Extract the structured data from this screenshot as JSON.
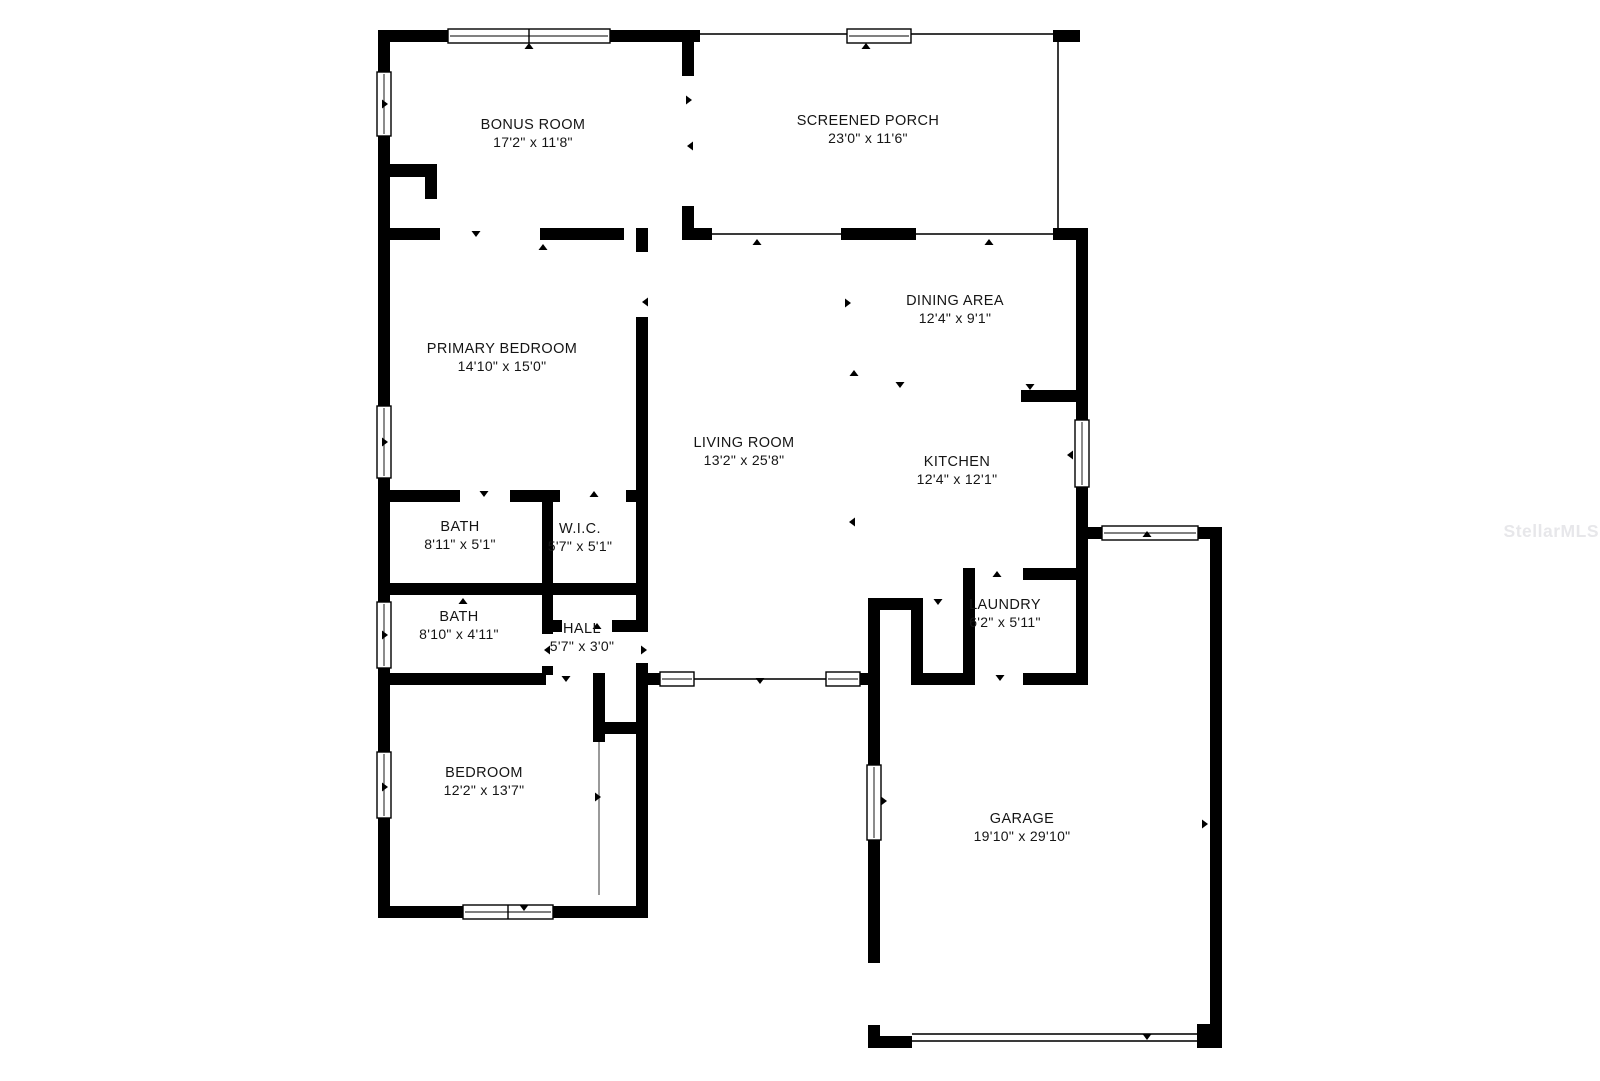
{
  "watermark": "StellarMLS",
  "plan": {
    "rooms": [
      {
        "id": "bonus-room",
        "name": "BONUS ROOM",
        "dims": "17'2\" x 11'8\""
      },
      {
        "id": "screened-porch",
        "name": "SCREENED PORCH",
        "dims": "23'0\" x 11'6\""
      },
      {
        "id": "primary-bedroom",
        "name": "PRIMARY BEDROOM",
        "dims": "14'10\" x 15'0\""
      },
      {
        "id": "dining-area",
        "name": "DINING AREA",
        "dims": "12'4\" x 9'1\""
      },
      {
        "id": "living-room",
        "name": "LIVING ROOM",
        "dims": "13'2\" x 25'8\""
      },
      {
        "id": "kitchen",
        "name": "KITCHEN",
        "dims": "12'4\" x 12'1\""
      },
      {
        "id": "bath-1",
        "name": "BATH",
        "dims": "8'11\" x 5'1\""
      },
      {
        "id": "wic",
        "name": "W.I.C.",
        "dims": "5'7\" x 5'1\""
      },
      {
        "id": "bath-2",
        "name": "BATH",
        "dims": "8'10\" x 4'11\""
      },
      {
        "id": "hall",
        "name": "HALL",
        "dims": "5'7\" x 3'0\""
      },
      {
        "id": "laundry",
        "name": "LAUNDRY",
        "dims": "6'2\" x 5'11\""
      },
      {
        "id": "bedroom",
        "name": "BEDROOM",
        "dims": "12'2\" x 13'7\""
      },
      {
        "id": "garage",
        "name": "GARAGE",
        "dims": "19'10\" x 29'10\""
      }
    ]
  }
}
